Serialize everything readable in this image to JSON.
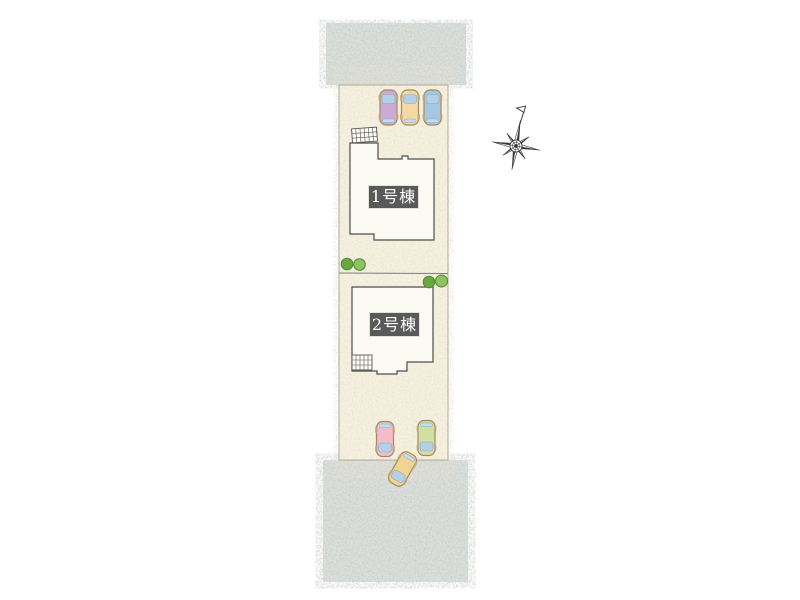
{
  "page": {
    "background": "#ffffff"
  },
  "plan": {
    "lot": {
      "fill": "#f6f1e1",
      "border": "#a09a8a",
      "boundary_line": "#7d7d76"
    },
    "roads": {
      "fill": "#dde1dd",
      "speckle": "#8c948c",
      "positions": [
        "top",
        "bottom"
      ]
    },
    "buildings": [
      {
        "id": "building-1",
        "label": "1号棟",
        "label_bg": "#595959",
        "label_text_color": "#ffffff",
        "fill": "#fcfbf3",
        "outline": "#4d4d4d"
      },
      {
        "id": "building-2",
        "label": "2号棟",
        "label_bg": "#595959",
        "label_text_color": "#ffffff",
        "fill": "#fcfbf3",
        "outline": "#4d4d4d"
      }
    ],
    "cars": [
      {
        "slot": "top-1",
        "color": "#c9abd5",
        "facing": "up"
      },
      {
        "slot": "top-2",
        "color": "#f5d9a2",
        "facing": "up"
      },
      {
        "slot": "top-3",
        "color": "#a6c6e3",
        "facing": "up"
      },
      {
        "slot": "bottom-1",
        "color": "#f3bcca",
        "facing": "down"
      },
      {
        "slot": "bottom-2",
        "color": "#cfe0a0",
        "facing": "down"
      },
      {
        "slot": "driveway",
        "color": "#f2d492",
        "facing": "down-left"
      }
    ],
    "glass_color": "#b3d0e6",
    "trees": [
      {
        "pair": "lot1-left",
        "colors": [
          "#69a743",
          "#8fc361"
        ]
      },
      {
        "pair": "lot2-right",
        "colors": [
          "#69a743",
          "#8fc361"
        ]
      }
    ],
    "compass": {
      "symbol": "eight-point-star-with-flag",
      "stroke": "#3a3a3a"
    }
  }
}
